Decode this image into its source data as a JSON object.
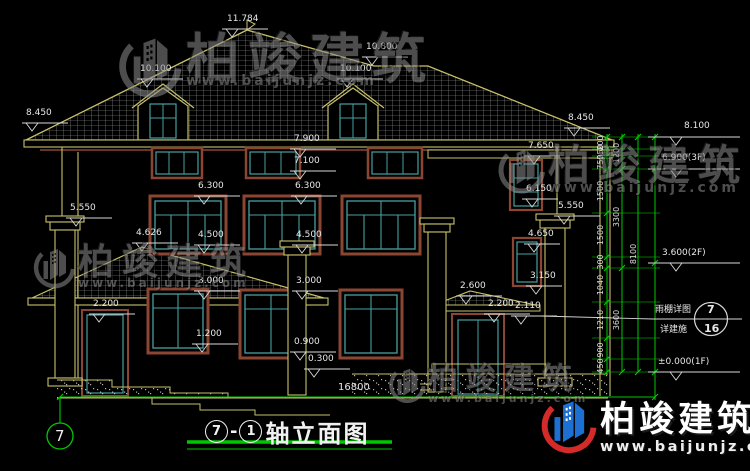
{
  "drawing": {
    "title": {
      "axis_left": "7",
      "dash": "-",
      "axis_right": "1",
      "name": "轴立面图"
    },
    "bottom_axis_bubble": "7",
    "overall_dim": "16800",
    "callout": {
      "line1": "雨棚详图",
      "line2": "详建施",
      "detail_no": "7",
      "sheet_no": "16"
    },
    "levels": {
      "ridge": "11.784",
      "dormer_left": "10.100",
      "hip": "10.800",
      "dormer_right": "10.100",
      "eave_left": "8.450",
      "eave_right": "8.450",
      "lv8100": "8.100",
      "lv7900": "7.900",
      "lv7100": "7.100",
      "lv7650": "7.650",
      "lv6900": "6.900(3F)",
      "w2_head_left": "6.300",
      "w2_head_right": "6.300",
      "lv6150": "6.150",
      "cap_left": "5.550",
      "cap_right": "5.550",
      "porch_peak": "4.626",
      "w2_sill_left": "4.500",
      "w2_sill_right": "4.500",
      "lv4650": "4.650",
      "lv3600": "3.600(2F)",
      "porch_eave": "3.000",
      "w1_head": "3.000",
      "lv3150": "3.150",
      "canopy_peak": "2.600",
      "door_left_head": "2.200",
      "door_right_head": "2.200",
      "lv2110": "2.110",
      "w1_sill_left": "1.200",
      "w1_sill_center": "0.900",
      "porch_floor": "0.300",
      "lv0": "±0.000(1F)"
    },
    "chain": {
      "c1": [
        "200",
        "250",
        "750",
        "1500",
        "1500",
        "300",
        "1040",
        "1210",
        "900",
        "450"
      ],
      "c2": [
        "1200",
        "3300",
        "3600"
      ],
      "c3": [
        "8100"
      ]
    }
  },
  "watermark": {
    "brand": "柏竣建筑",
    "url": "www.baijunjz.com"
  },
  "colors": {
    "background": "#000000",
    "linework": "#c8c06a",
    "dimension_text": "#e8e8e8",
    "dimension_green": "#00c800",
    "window_frame": "#46a0a0",
    "window_trim": "#8a4632",
    "brand_blue": "#1d6fd1",
    "brand_red": "#d42a2a"
  }
}
